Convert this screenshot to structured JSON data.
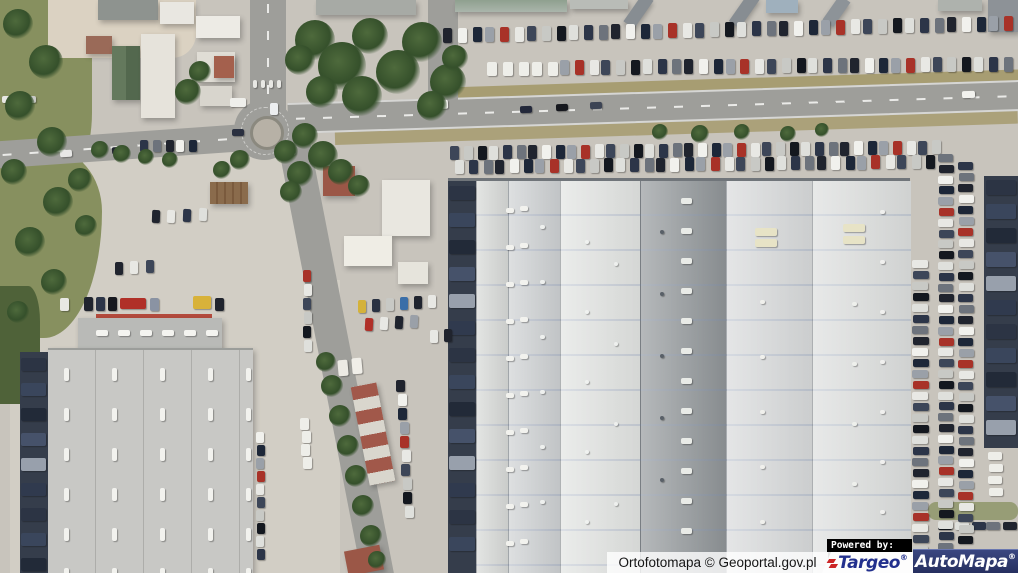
{
  "attribution": {
    "text": "Ortofotomapa © Geoportal.gov.pl"
  },
  "branding": {
    "powered_by": "Powered by:",
    "targeo_name": "Targeo",
    "targeo_reg": "®",
    "automapa_name": "AutoMapa",
    "automapa_reg": "®"
  },
  "palette": {
    "pavement": "#c8c4bc",
    "pavement-light": "#d2cec5",
    "road": "#9e9e9a",
    "grass": "#87905f",
    "grass-dark": "#4f6239",
    "dirt": "#a79d72",
    "sand": "#dbd2c2",
    "navy-dock": "#353d4b",
    "roof-bl": "#c8c8c5",
    "roof-bl-top": "#b9bab7",
    "red-roof": "#9b5747",
    "green-roof": "#5c7156",
    "white-roof": "#e9e7e1",
    "red-line": "#b34a3c",
    "targeo-blue": "#22308d",
    "targeo-red": "#cc2526",
    "automapa-top": "#3a4780",
    "automapa-bottom": "#252e5e"
  },
  "scene": {
    "palettes": {
      "cars": [
        "#20242e",
        "#e8e8e4",
        "#2c3548",
        "#9aa0a8",
        "#14181f",
        "#f1f1ed",
        "#3d4658",
        "#6d737c",
        "#a83228",
        "#dfe0dc",
        "#1d2738",
        "#c8c9c5"
      ],
      "light": [
        "#eeeee9",
        "#dcdcd8",
        "#f4f4f0",
        "#c9cac6",
        "#e4e4e0"
      ],
      "trucks": [
        "#2c3444",
        "#3a465c",
        "#222a38",
        "#46526a",
        "#98a0ac",
        "#303a4e"
      ]
    },
    "car_rows": [
      {
        "x": 443,
        "y": 28,
        "n": 41,
        "gx": 14,
        "gy": -0.3,
        "w": 9,
        "h": 15
      },
      {
        "x": 560,
        "y": 60,
        "n": 33,
        "gx": 13.8,
        "gy": -0.1,
        "w": 9,
        "h": 15,
        "cs": 3
      },
      {
        "x": 487,
        "y": 62,
        "n": 5,
        "gx": 15,
        "w": 10,
        "h": 14,
        "pal": "light"
      },
      {
        "x": 450,
        "y": 146,
        "n": 38,
        "gx": 13,
        "gy": -0.15,
        "w": 9,
        "h": 14,
        "cs": 6
      },
      {
        "x": 455,
        "y": 160,
        "n": 36,
        "gx": 13.4,
        "gy": -0.15,
        "w": 9,
        "h": 14,
        "cs": 9
      },
      {
        "x": 140,
        "y": 140,
        "n": 5,
        "gx": 12,
        "w": 8,
        "h": 12,
        "cs": 2
      },
      {
        "x": 938,
        "y": 522,
        "n": 5,
        "gx": 16,
        "w": 14,
        "h": 8,
        "cs": 4
      },
      {
        "x": 2,
        "y": 96,
        "n": 3,
        "gx": 11,
        "w": 10,
        "h": 7,
        "cs": 1
      }
    ],
    "car_cols": [
      {
        "x": 912,
        "y": 260,
        "n": 27,
        "gy": 11,
        "w": 16,
        "h": 8,
        "cs": 1
      },
      {
        "x": 938,
        "y": 154,
        "n": 37,
        "gy": 10.8,
        "w": 15,
        "h": 8,
        "cs": 7
      },
      {
        "x": 958,
        "y": 162,
        "n": 35,
        "gy": 11,
        "w": 15,
        "h": 8,
        "cs": 2
      },
      {
        "x": 256,
        "y": 432,
        "n": 10,
        "gy": 13,
        "w": 8,
        "h": 11,
        "cs": 5
      },
      {
        "x": 303,
        "y": 270,
        "n": 6,
        "gy": 14,
        "w": 8,
        "h": 12,
        "cs": 8
      },
      {
        "x": 300,
        "y": 418,
        "n": 4,
        "gy": 13,
        "gx": 0.6,
        "w": 9,
        "h": 12,
        "pal": "light"
      },
      {
        "x": 396,
        "y": 380,
        "n": 10,
        "gy": 14,
        "gx": 0.9,
        "w": 9,
        "h": 12,
        "cs": 0
      },
      {
        "x": 988,
        "y": 452,
        "n": 4,
        "gy": 12,
        "w": 14,
        "h": 8,
        "pal": "light"
      }
    ],
    "truck_rows": [
      {
        "x": 449,
        "y": 186,
        "n": 14,
        "gy": 27,
        "w": 26,
        "h": 14
      },
      {
        "x": 986,
        "y": 180,
        "n": 11,
        "gy": 24,
        "w": 30,
        "h": 15
      },
      {
        "x": 21,
        "y": 358,
        "n": 9,
        "gy": 25,
        "w": 25,
        "h": 13
      }
    ],
    "vehicles": [
      [
        432,
        100,
        16,
        9,
        "#f0f0ec",
        -2
      ],
      [
        520,
        106,
        12,
        7,
        "#23283a",
        -2
      ],
      [
        556,
        104,
        12,
        7,
        "#16181e",
        -2
      ],
      [
        590,
        102,
        12,
        7,
        "#3c4454",
        -2
      ],
      [
        962,
        91,
        13,
        7,
        "#f2f2ee",
        -2
      ],
      [
        60,
        150,
        12,
        7,
        "#e8e8e6",
        -4
      ],
      [
        112,
        147,
        11,
        7,
        "#20242e",
        -4
      ],
      [
        270,
        103,
        8,
        12,
        "#eceef0",
        0
      ],
      [
        232,
        129,
        12,
        7,
        "#2a3040",
        0
      ],
      [
        284,
        150,
        11,
        7,
        "#e6e6e2",
        -25
      ],
      [
        230,
        98,
        16,
        9,
        "#efefeb",
        0
      ],
      [
        358,
        300,
        8,
        13,
        "#d4b23a",
        0
      ],
      [
        372,
        299,
        8,
        13,
        "#2a3242",
        0
      ],
      [
        386,
        298,
        8,
        13,
        "#c8c9c5",
        0
      ],
      [
        400,
        297,
        8,
        13,
        "#3a6ea8",
        0
      ],
      [
        414,
        296,
        8,
        13,
        "#20242e",
        0
      ],
      [
        428,
        295,
        8,
        13,
        "#e8e8e4",
        0
      ],
      [
        365,
        318,
        8,
        13,
        "#b03028",
        3
      ],
      [
        380,
        317,
        8,
        13,
        "#e8e8e4",
        3
      ],
      [
        395,
        316,
        8,
        13,
        "#20242e",
        3
      ],
      [
        410,
        315,
        8,
        13,
        "#9aa0a8",
        3
      ],
      [
        430,
        330,
        8,
        13,
        "#e8e8e4",
        0
      ],
      [
        444,
        329,
        8,
        13,
        "#20242e",
        0
      ],
      [
        152,
        210,
        8,
        13,
        "#20242e",
        2
      ],
      [
        167,
        210,
        8,
        13,
        "#e8e8e4",
        2
      ],
      [
        183,
        209,
        8,
        13,
        "#2c3548",
        2
      ],
      [
        199,
        208,
        8,
        13,
        "#dfe0dc",
        2
      ],
      [
        115,
        262,
        8,
        13,
        "#20242e",
        0
      ],
      [
        130,
        261,
        8,
        13,
        "#e8e8e4",
        0
      ],
      [
        146,
        260,
        8,
        13,
        "#3d4658",
        0
      ],
      [
        338,
        360,
        10,
        16,
        "#eceae4",
        -5
      ],
      [
        352,
        358,
        10,
        16,
        "#f0eee8",
        -5
      ],
      [
        60,
        298,
        9,
        13,
        "#e8e8e4",
        0
      ],
      [
        84,
        297,
        9,
        14,
        "#20242e",
        0
      ],
      [
        96,
        297,
        9,
        14,
        "#2c3548",
        0
      ],
      [
        108,
        297,
        9,
        14,
        "#16181e",
        0
      ],
      [
        120,
        298,
        26,
        11,
        "#b03028",
        0
      ],
      [
        150,
        298,
        9,
        13,
        "#8a93a3",
        0
      ],
      [
        193,
        296,
        18,
        13,
        "#d8b23a",
        0
      ],
      [
        215,
        298,
        9,
        13,
        "#20242e",
        0
      ]
    ],
    "marks": [
      {
        "x": 506,
        "y": 208,
        "n": 10,
        "gy": 37,
        "w": 8,
        "h": 5,
        "c": "#f2f2ee"
      },
      {
        "x": 520,
        "y": 206,
        "n": 10,
        "gy": 37,
        "w": 8,
        "h": 5,
        "c": "#f2f2ee"
      },
      {
        "x": 540,
        "y": 225,
        "n": 6,
        "gy": 55,
        "w": 5,
        "h": 4,
        "c": "#eef0ee"
      },
      {
        "x": 585,
        "y": 240,
        "n": 5,
        "gy": 70,
        "w": 4,
        "h": 4,
        "c": "#f0f2f0"
      },
      {
        "x": 614,
        "y": 262,
        "n": 4,
        "gy": 80,
        "w": 4,
        "h": 4,
        "c": "#eef0ee"
      },
      {
        "x": 681,
        "y": 198,
        "n": 12,
        "gy": 30,
        "w": 11,
        "h": 6,
        "c": "#e9ebe7"
      },
      {
        "x": 660,
        "y": 230,
        "n": 5,
        "gy": 62,
        "w": 4,
        "h": 4,
        "c": "#596068"
      },
      {
        "x": 760,
        "y": 300,
        "n": 5,
        "gy": 55,
        "w": 5,
        "h": 4,
        "c": "#f0f0ec"
      },
      {
        "x": 852,
        "y": 302,
        "n": 5,
        "gy": 60,
        "w": 5,
        "h": 4,
        "c": "#eef0ec"
      },
      {
        "x": 880,
        "y": 210,
        "n": 7,
        "gy": 50,
        "w": 5,
        "h": 4,
        "c": "#f0f0ee"
      },
      {
        "x": 755,
        "y": 228,
        "n": 2,
        "gy": 11,
        "w": 22,
        "h": 8,
        "c": "#e7e3c6"
      },
      {
        "x": 843,
        "y": 224,
        "n": 2,
        "gy": 12,
        "w": 22,
        "h": 8,
        "c": "#e7e3c6"
      },
      {
        "x": 64,
        "y": 368,
        "n": 6,
        "gy": 40,
        "w": 5,
        "h": 13,
        "c": "#f2f2ee"
      },
      {
        "x": 112,
        "y": 368,
        "n": 6,
        "gy": 40,
        "w": 5,
        "h": 13,
        "c": "#f2f2ee"
      },
      {
        "x": 160,
        "y": 368,
        "n": 6,
        "gy": 40,
        "w": 5,
        "h": 13,
        "c": "#f2f2ee"
      },
      {
        "x": 208,
        "y": 368,
        "n": 6,
        "gy": 40,
        "w": 5,
        "h": 13,
        "c": "#f2f2ee"
      },
      {
        "x": 246,
        "y": 368,
        "n": 6,
        "gy": 40,
        "w": 5,
        "h": 13,
        "c": "#f2f2ee"
      },
      {
        "x": 96,
        "y": 330,
        "n": 6,
        "gx": 22,
        "w": 12,
        "h": 6,
        "c": "#f4f4f0"
      },
      {
        "x": 253,
        "y": 80,
        "n": 4,
        "gx": 8,
        "w": 4,
        "h": 8,
        "c": "#e8e8e4"
      }
    ],
    "trees": [
      [
        315,
        40,
        20
      ],
      [
        342,
        66,
        24
      ],
      [
        370,
        36,
        18
      ],
      [
        398,
        72,
        22
      ],
      [
        422,
        42,
        20
      ],
      [
        448,
        82,
        18
      ],
      [
        432,
        106,
        15
      ],
      [
        362,
        96,
        20
      ],
      [
        322,
        92,
        16
      ],
      [
        300,
        60,
        15
      ],
      [
        455,
        58,
        13
      ],
      [
        188,
        92,
        13
      ],
      [
        200,
        72,
        11
      ],
      [
        305,
        136,
        13
      ],
      [
        323,
        156,
        15
      ],
      [
        300,
        174,
        13
      ],
      [
        291,
        192,
        11
      ],
      [
        341,
        172,
        13
      ],
      [
        359,
        186,
        11
      ],
      [
        286,
        152,
        12
      ],
      [
        18,
        24,
        15
      ],
      [
        46,
        62,
        17
      ],
      [
        20,
        106,
        15
      ],
      [
        52,
        142,
        15
      ],
      [
        14,
        172,
        13
      ],
      [
        58,
        202,
        15
      ],
      [
        30,
        242,
        15
      ],
      [
        54,
        282,
        13
      ],
      [
        18,
        312,
        11
      ],
      [
        80,
        180,
        12
      ],
      [
        86,
        226,
        11
      ],
      [
        240,
        160,
        10
      ],
      [
        222,
        170,
        9
      ],
      [
        100,
        150,
        9
      ],
      [
        122,
        154,
        9
      ],
      [
        146,
        157,
        8
      ],
      [
        170,
        160,
        8
      ],
      [
        332,
        386,
        11
      ],
      [
        340,
        416,
        11
      ],
      [
        348,
        446,
        11
      ],
      [
        356,
        476,
        11
      ],
      [
        363,
        506,
        11
      ],
      [
        371,
        536,
        11
      ],
      [
        377,
        560,
        9
      ],
      [
        326,
        362,
        10
      ],
      [
        660,
        132,
        8
      ],
      [
        700,
        134,
        9
      ],
      [
        742,
        132,
        8
      ],
      [
        788,
        134,
        8
      ],
      [
        822,
        130,
        7
      ]
    ]
  }
}
